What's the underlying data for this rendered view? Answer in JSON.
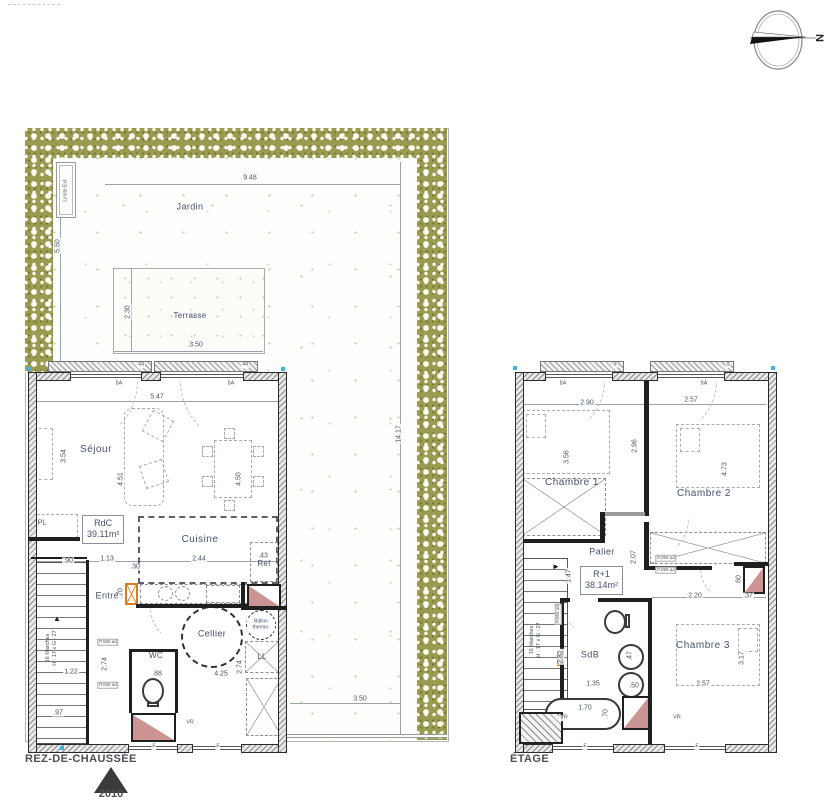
{
  "compass": {
    "north_label": "N"
  },
  "footer": {
    "marker_year": "2010"
  },
  "plan_rdc": {
    "title": "REZ-DE-CHAUSSÉE",
    "boundary_label": "Limite Ext.",
    "area_box": {
      "line1": "RdC",
      "line2": "39.11m²"
    },
    "stairs_note": {
      "line1": "16 Marches",
      "line2": "H : 17 x G : 27"
    },
    "rooms": [
      {
        "t": "Jardin",
        "x": 190,
        "y": 207,
        "c": "room-md"
      },
      {
        "t": "Terrasse",
        "x": 190,
        "y": 316,
        "c": "room-sm"
      },
      {
        "t": "Séjour",
        "x": 96,
        "y": 450,
        "c": "room-lg"
      },
      {
        "t": "Cuisine",
        "x": 200,
        "y": 540,
        "c": "room-lg"
      },
      {
        "t": "Entrée",
        "x": 110,
        "y": 596,
        "c": "room-md"
      },
      {
        "t": "Cellier",
        "x": 212,
        "y": 634,
        "c": "room-md"
      },
      {
        "t": "WC",
        "x": 156,
        "y": 656,
        "c": "room-sm"
      },
      {
        "t": "PL",
        "x": 42,
        "y": 523,
        "c": "room-xs"
      },
      {
        "t": "Réf",
        "x": 264,
        "y": 564,
        "c": "room-sm"
      },
      {
        "t": "LL",
        "x": 262,
        "y": 657,
        "c": "room-sm"
      },
      {
        "t": "Ballon thermo.",
        "x": 261,
        "y": 625,
        "c": "room-2xs"
      }
    ],
    "dims": [
      {
        "t": "9.48",
        "x": 250,
        "y": 178
      },
      {
        "t": "5.50",
        "x": 58,
        "y": 246,
        "r": -90
      },
      {
        "t": "14.17",
        "x": 399,
        "y": 434,
        "r": -90
      },
      {
        "t": "2.30",
        "x": 128,
        "y": 312,
        "r": -90
      },
      {
        "t": "3.50",
        "x": 196,
        "y": 345
      },
      {
        "t": "3.50",
        "x": 360,
        "y": 699
      },
      {
        "t": "5.47",
        "x": 157,
        "y": 397
      },
      {
        "t": "3.54",
        "x": 64,
        "y": 456,
        "r": -90
      },
      {
        "t": "4.51",
        "x": 121,
        "y": 479,
        "r": -90
      },
      {
        "t": "4.50",
        "x": 239,
        "y": 479,
        "r": -90
      },
      {
        "t": ".90",
        "x": 68,
        "y": 561
      },
      {
        "t": "1.13",
        "x": 107,
        "y": 559
      },
      {
        "t": ".30",
        "x": 135,
        "y": 567
      },
      {
        "t": "2.44",
        "x": 199,
        "y": 559
      },
      {
        "t": ".43",
        "x": 263,
        "y": 556
      },
      {
        "t": ".70",
        "x": 121,
        "y": 593,
        "r": -90
      },
      {
        "t": "1.22",
        "x": 71,
        "y": 672
      },
      {
        "t": ".88",
        "x": 157,
        "y": 674
      },
      {
        "t": "2.74",
        "x": 105,
        "y": 664,
        "r": -90
      },
      {
        "t": "4.25",
        "x": 221,
        "y": 674
      },
      {
        "t": "2.74",
        "x": 240,
        "y": 667,
        "r": -90
      },
      {
        "t": ".97",
        "x": 58,
        "y": 713
      }
    ],
    "codes": [
      {
        "t": "8A",
        "x": 119,
        "y": 384,
        "c": "tiny"
      },
      {
        "t": "8A",
        "x": 231,
        "y": 384,
        "c": "tiny"
      },
      {
        "t": "44",
        "x": 141,
        "y": 365,
        "c": "tiny"
      },
      {
        "t": "44",
        "x": 245,
        "y": 365,
        "c": "tiny"
      },
      {
        "t": "VR",
        "x": 190,
        "y": 723,
        "c": "tiny"
      },
      {
        "t": "F",
        "x": 154,
        "y": 747,
        "c": "tiny"
      },
      {
        "t": "F",
        "x": 218,
        "y": 747,
        "c": "tiny"
      },
      {
        "t": "P.059 ad",
        "x": 100,
        "y": 543,
        "c": "tiny"
      },
      {
        "t": "P.059 ad",
        "x": 108,
        "y": 642,
        "c": "tinybox"
      },
      {
        "t": "P.059 ad",
        "x": 108,
        "y": 685,
        "c": "tinybox"
      }
    ]
  },
  "plan_etage": {
    "title": "ÉTAGE",
    "area_box": {
      "line1": "R+1",
      "line2": "38.14m²"
    },
    "stairs_note": {
      "line1": "16 Marches",
      "line2": "H : 17 x G : 27"
    },
    "rooms": [
      {
        "t": "Chambre 1",
        "x": 572,
        "y": 483,
        "c": "room-lg"
      },
      {
        "t": "Chambre 2",
        "x": 704,
        "y": 494,
        "c": "room-lg"
      },
      {
        "t": "Chambre 3",
        "x": 703,
        "y": 646,
        "c": "room-lg"
      },
      {
        "t": "Palier",
        "x": 602,
        "y": 552,
        "c": "room-md"
      },
      {
        "t": "SdB",
        "x": 590,
        "y": 655,
        "c": "room-md"
      }
    ],
    "dims": [
      {
        "t": "2.90",
        "x": 587,
        "y": 403
      },
      {
        "t": "2.57",
        "x": 691,
        "y": 400
      },
      {
        "t": "3.56",
        "x": 567,
        "y": 457,
        "r": -90
      },
      {
        "t": "2.96",
        "x": 635,
        "y": 446,
        "r": -90
      },
      {
        "t": "4.73",
        "x": 725,
        "y": 469,
        "r": -90
      },
      {
        "t": "2.07",
        "x": 634,
        "y": 557,
        "r": -90
      },
      {
        "t": "1.47",
        "x": 569,
        "y": 576,
        "r": -90
      },
      {
        "t": "1.88",
        "x": 605,
        "y": 592
      },
      {
        "t": "2.20",
        "x": 695,
        "y": 596
      },
      {
        "t": ".37",
        "x": 748,
        "y": 596
      },
      {
        "t": "2.82",
        "x": 561,
        "y": 657,
        "r": -90
      },
      {
        "t": "1.35",
        "x": 593,
        "y": 684
      },
      {
        "t": ".47",
        "x": 630,
        "y": 656,
        "r": -90
      },
      {
        "t": ".50",
        "x": 634,
        "y": 686
      },
      {
        "t": "3.17",
        "x": 742,
        "y": 658,
        "r": -90
      },
      {
        "t": "2.57",
        "x": 703,
        "y": 684
      },
      {
        "t": "1.70",
        "x": 585,
        "y": 708
      },
      {
        "t": ".70",
        "x": 606,
        "y": 714,
        "r": -90
      },
      {
        "t": ".60",
        "x": 739,
        "y": 580,
        "r": -90
      }
    ],
    "codes": [
      {
        "t": "8A",
        "x": 563,
        "y": 384,
        "c": "tiny"
      },
      {
        "t": "8A",
        "x": 704,
        "y": 384,
        "c": "tiny"
      },
      {
        "t": "d",
        "x": 615,
        "y": 365,
        "c": "tiny"
      },
      {
        "t": "d",
        "x": 728,
        "y": 365,
        "c": "tiny"
      },
      {
        "t": "VR",
        "x": 564,
        "y": 718,
        "c": "tiny"
      },
      {
        "t": "VR",
        "x": 677,
        "y": 718,
        "c": "tiny"
      },
      {
        "t": "F",
        "x": 585,
        "y": 747,
        "c": "tiny"
      },
      {
        "t": "F",
        "x": 697,
        "y": 747,
        "c": "tiny"
      },
      {
        "t": "P.059 ad",
        "x": 666,
        "y": 558,
        "c": "tinybox"
      },
      {
        "t": "P.059 ad",
        "x": 666,
        "y": 570,
        "c": "tinybox"
      },
      {
        "t": "P.059 ad",
        "x": 558,
        "y": 614,
        "r": -90,
        "c": "tinybox"
      }
    ]
  }
}
